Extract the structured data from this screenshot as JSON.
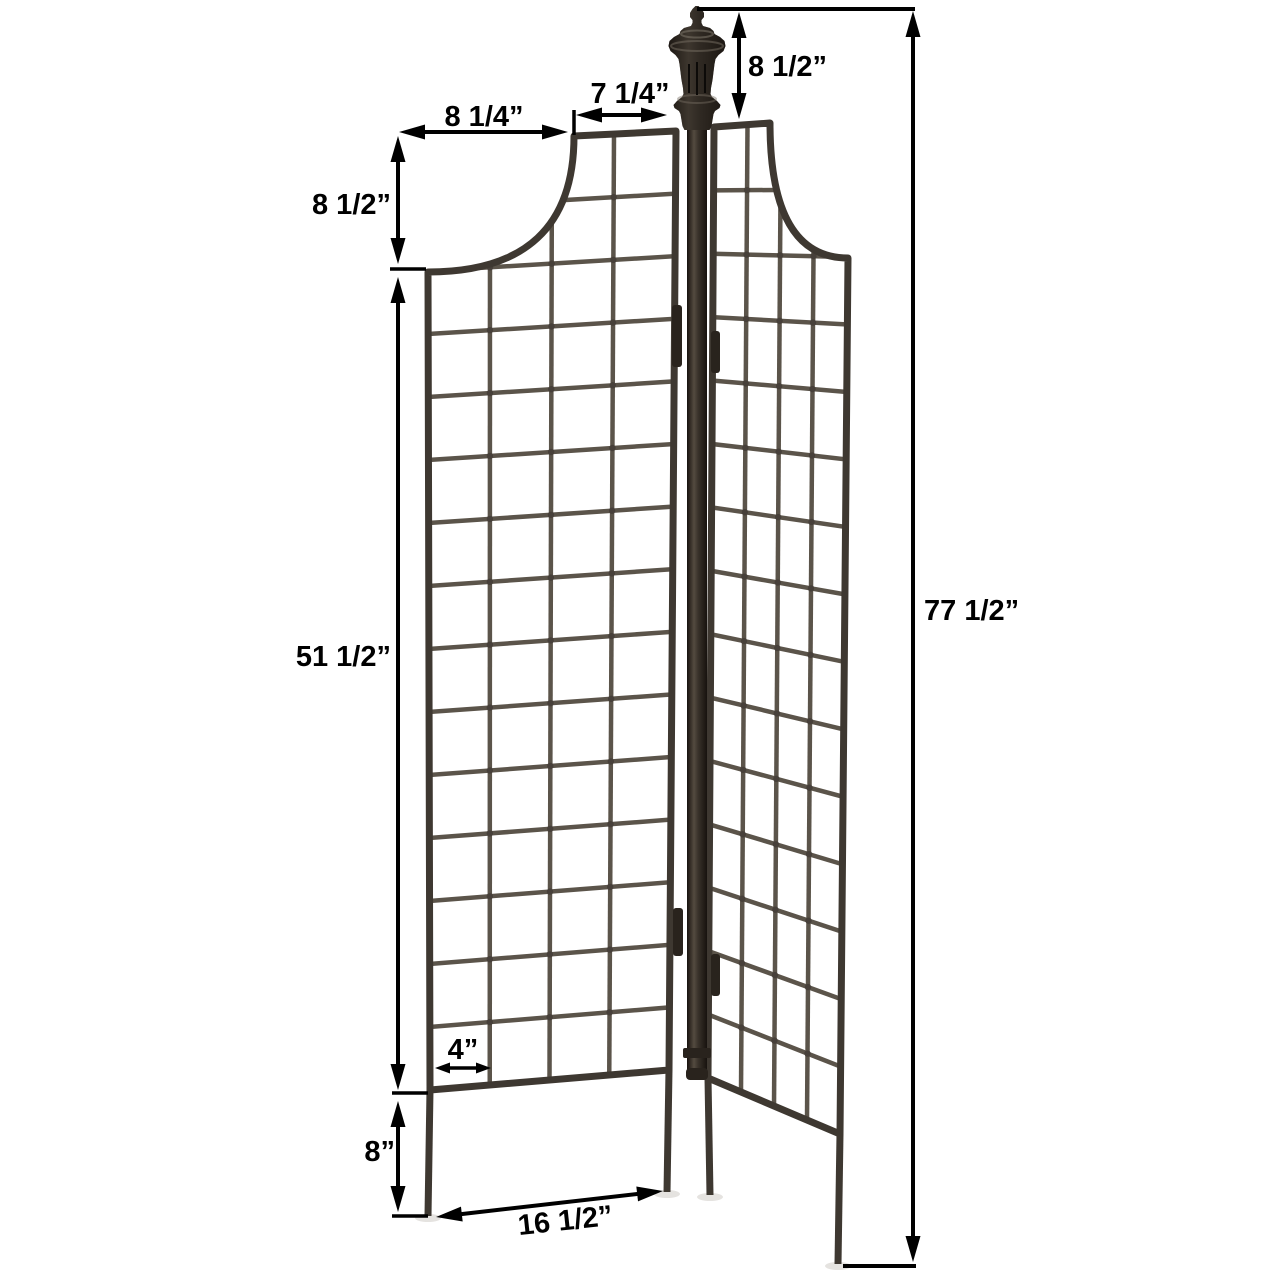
{
  "diagram": {
    "type": "product-dimension-diagram",
    "subject": "two-panel garden trellis screen with center finial post"
  },
  "dimensions": {
    "finial_height": "8 1/2”",
    "panel_top_width": "7 1/4”",
    "scoop_width": "8 1/4”",
    "scoop_height": "8 1/2”",
    "grid_height": "51 1/2”",
    "total_height": "77 1/2”",
    "grid_square": "4”",
    "leg_height": "8”",
    "panel_width": "16 1/2”"
  },
  "colors": {
    "background": "#ffffff",
    "dimension_ink": "#000000",
    "metal_frame": "#3e3831",
    "metal_wire": "#5b544a",
    "metal_weld": "#47403a",
    "metal_dark": "#29231d",
    "shadow": "#cfccc7"
  }
}
